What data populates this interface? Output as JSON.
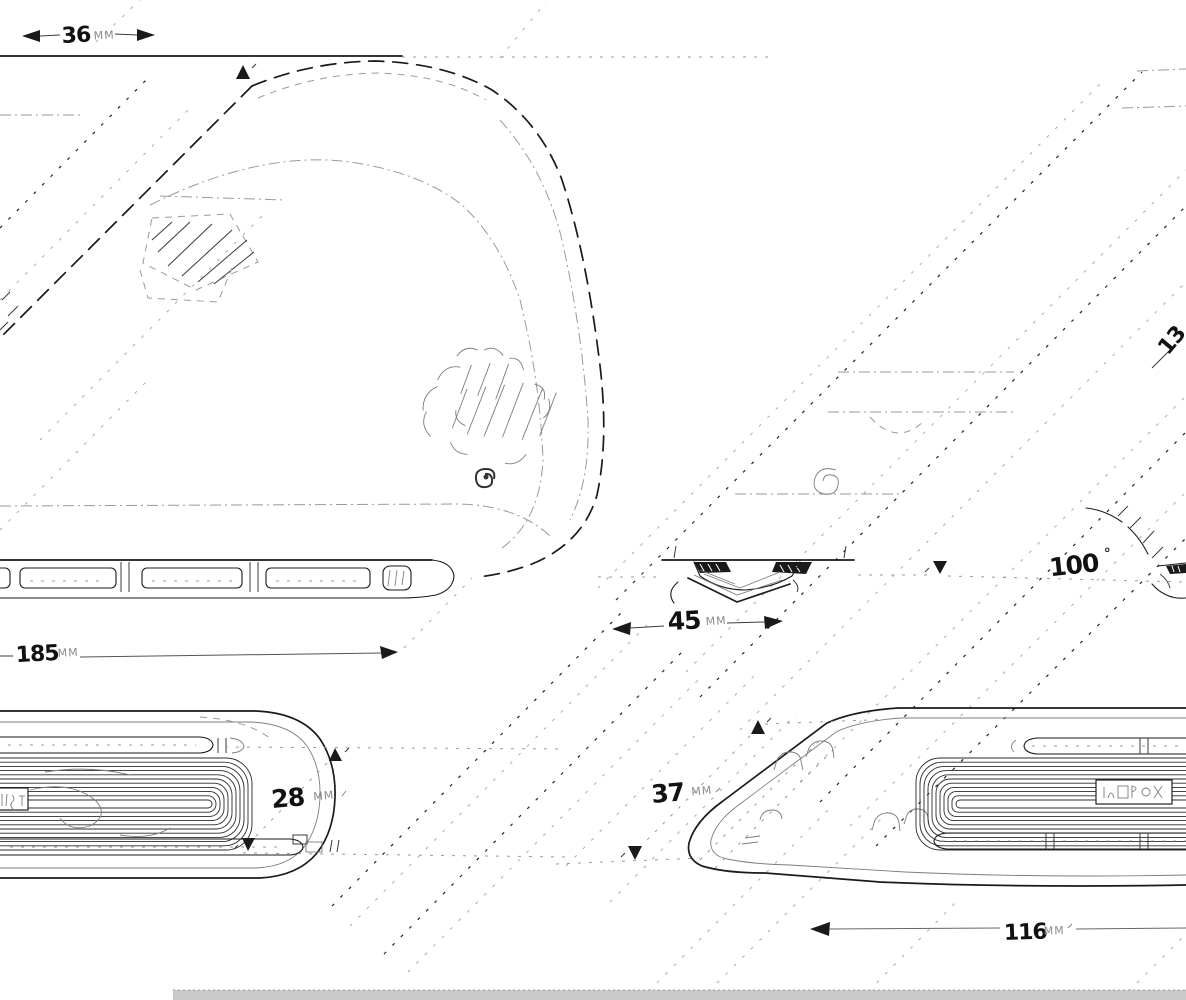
{
  "figure": {
    "kind": "patent-style multi-view line drawing",
    "dims": {
      "top_width": {
        "value": "36",
        "unit": "MM"
      },
      "front_length": {
        "value": "185",
        "unit": "MM"
      },
      "side_depth": {
        "value": "45",
        "unit": "MM"
      },
      "stand_angle": {
        "value": "100",
        "unit": "°"
      },
      "left_height": {
        "value": "28",
        "unit": "MM"
      },
      "right_height": {
        "value": "37",
        "unit": "MM"
      },
      "bottom_length": {
        "value": "116",
        "unit": "MM"
      },
      "diagonal_partial": {
        "value": "13",
        "unit": ""
      }
    },
    "colors": {
      "line": "#1a1a1a",
      "faint": "#9a9a9a",
      "footer_bar": "#c9c9c9"
    }
  }
}
